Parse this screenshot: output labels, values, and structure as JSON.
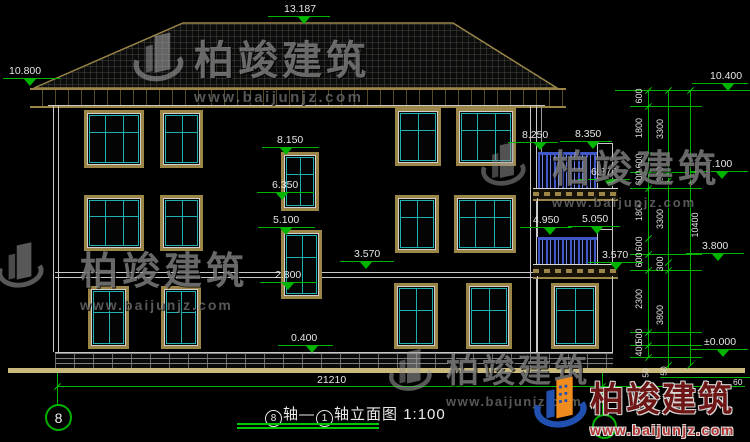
{
  "brand": {
    "name": "柏竣建筑",
    "url": "www.baijunjz.com"
  },
  "title": {
    "axis_from": "8",
    "axis_label": "轴",
    "dash": "—",
    "axis_to": "1",
    "suffix": "轴立面图",
    "scale": "1:100"
  },
  "axis_bubbles": {
    "left": "8",
    "right": ""
  },
  "levels": {
    "ridge": "13.187",
    "eave_left": "10.800",
    "eave_right": "10.400",
    "floor3": "7.100",
    "floor2": "3.800",
    "ground": "±0.000",
    "stair_win_top": "8.150",
    "stair_win_bottom": "6.350",
    "stair_win2_top": "5.100",
    "stair_win2_bottom": "2.800",
    "band_main": "3.570",
    "plinth": "0.400",
    "balc2_rail_top": "8.250",
    "balc2_pillar_top": "8.350",
    "balc2_floor": "6.870",
    "balc1_rail_top": "4.950",
    "balc1_pillar_top": "5.050",
    "balc1_floor": "3.570"
  },
  "dimensions": {
    "total_width": "21210",
    "right_chain_inner": [
      "600",
      "1800",
      "600",
      "600",
      "1800",
      "600",
      "600",
      "2300",
      "500",
      "400"
    ],
    "right_chain_middle": [
      "3300",
      "300",
      "3300",
      "300",
      "3800"
    ],
    "right_chain_outer": [
      "10400"
    ],
    "small_dims": [
      "50",
      "50",
      "60"
    ]
  }
}
